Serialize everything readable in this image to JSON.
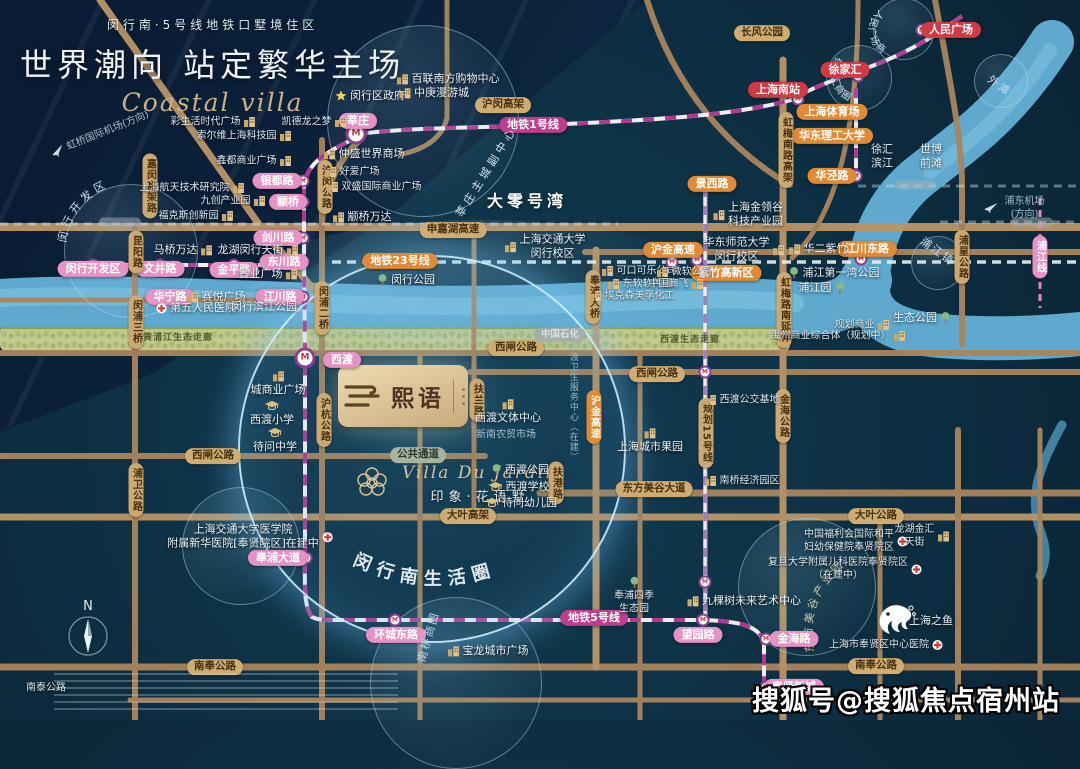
{
  "header": {
    "subtitle": "闵行南·5号线地铁口墅境住区",
    "title": "世界潮向 站定繁华主场",
    "script": "Coastal villa"
  },
  "project": {
    "name": "熙语"
  },
  "villa": {
    "en": "Villa Du Jardin",
    "cn": "印象·花语墅"
  },
  "watermark": "搜狐号@搜狐焦点宿州站",
  "compass": "N",
  "colors": {
    "background": "#0d2e41",
    "river": "#5fa9cf",
    "road": "#a9855c",
    "metro_pink": "#e493c4",
    "metro_magenta": "#bc3e8e",
    "orange": "#df8a35",
    "road_pill": "#cfac72",
    "red": "#cf3b45",
    "green_band": "#c3c98e"
  },
  "curved": {
    "life_circle": "闵行南生活圈",
    "renmin": "人民广场商圈",
    "xujiahui": "徐家汇商圈",
    "kaifaqu": "闵行开发区",
    "dongfang": "东方美谷产业园"
  },
  "labels": [
    {
      "t": "莘庄",
      "x": 358,
      "y": 121,
      "c": "pk"
    },
    {
      "t": "银都路",
      "x": 277,
      "y": 181,
      "c": "pk"
    },
    {
      "t": "颛桥",
      "x": 288,
      "y": 202,
      "c": "pk"
    },
    {
      "t": "剑川路",
      "x": 278,
      "y": 238,
      "c": "pk"
    },
    {
      "t": "东川路",
      "x": 284,
      "y": 262,
      "c": "pk"
    },
    {
      "t": "金平路",
      "x": 234,
      "y": 270,
      "c": "pk"
    },
    {
      "t": "文井路",
      "x": 160,
      "y": 269,
      "c": "pk"
    },
    {
      "t": "闵行开发区",
      "x": 93,
      "y": 269,
      "c": "pk"
    },
    {
      "t": "华宁路",
      "x": 170,
      "y": 297,
      "c": "pk"
    },
    {
      "t": "江川路",
      "x": 280,
      "y": 297,
      "c": "pk"
    },
    {
      "t": "西渡",
      "x": 342,
      "y": 360,
      "c": "pk"
    },
    {
      "t": "奉浦大道",
      "x": 278,
      "y": 558,
      "c": "pk"
    },
    {
      "t": "环城东路",
      "x": 396,
      "y": 635,
      "c": "pk"
    },
    {
      "t": "望园路",
      "x": 698,
      "y": 635,
      "c": "pk"
    },
    {
      "t": "金海路",
      "x": 794,
      "y": 639,
      "c": "pk"
    },
    {
      "t": "奉贤新城",
      "x": 794,
      "y": 687,
      "c": "pk"
    },
    {
      "t": "浦江线",
      "x": 1040,
      "y": 257,
      "c": "pkv"
    },
    {
      "t": "地铁1号线",
      "x": 533,
      "y": 125,
      "c": "mg"
    },
    {
      "t": "地铁5号线",
      "x": 594,
      "y": 618,
      "c": "mg"
    },
    {
      "t": "人民广场",
      "x": 951,
      "y": 30,
      "c": "rd"
    },
    {
      "t": "徐家汇",
      "x": 845,
      "y": 70,
      "c": "rd"
    },
    {
      "t": "上海南站",
      "x": 778,
      "y": 90,
      "c": "rd"
    },
    {
      "t": "上海体育场",
      "x": 832,
      "y": 112,
      "c": "or"
    },
    {
      "t": "华东理工大学",
      "x": 832,
      "y": 136,
      "c": "or"
    },
    {
      "t": "华泾路",
      "x": 832,
      "y": 176,
      "c": "or"
    },
    {
      "t": "景西路",
      "x": 712,
      "y": 184,
      "c": "or"
    },
    {
      "t": "地铁23号线",
      "x": 400,
      "y": 261,
      "c": "or"
    },
    {
      "t": "沪金高速",
      "x": 673,
      "y": 250,
      "c": "or"
    },
    {
      "t": "江川东路",
      "x": 867,
      "y": 249,
      "c": "or"
    },
    {
      "t": "紫竹高新区",
      "x": 726,
      "y": 273,
      "c": "or"
    },
    {
      "t": "沪金高速",
      "x": 594,
      "y": 417,
      "c": "orv"
    },
    {
      "t": "长风公园",
      "x": 762,
      "y": 33,
      "c": "tn"
    },
    {
      "t": "沪闵高架",
      "x": 503,
      "y": 105,
      "c": "tn"
    },
    {
      "t": "申嘉湖高速",
      "x": 453,
      "y": 230,
      "c": "tn"
    },
    {
      "t": "西闸公路",
      "x": 516,
      "y": 348,
      "c": "tn"
    },
    {
      "t": "西闸公路",
      "x": 657,
      "y": 374,
      "c": "tn"
    },
    {
      "t": "西闸公路",
      "x": 213,
      "y": 456,
      "c": "tn"
    },
    {
      "t": "东方美谷大道",
      "x": 654,
      "y": 489,
      "c": "tn"
    },
    {
      "t": "大叶高架",
      "x": 468,
      "y": 516,
      "c": "tn"
    },
    {
      "t": "大叶公路",
      "x": 876,
      "y": 516,
      "c": "tn"
    },
    {
      "t": "南奉公路",
      "x": 876,
      "y": 666,
      "c": "tn"
    },
    {
      "t": "南奉公路",
      "x": 215,
      "y": 667,
      "c": "tn"
    },
    {
      "t": "公共通道",
      "x": 418,
      "y": 455,
      "c": "gn"
    },
    {
      "t": "中国石化",
      "x": 560,
      "y": 335,
      "c": "gy"
    },
    {
      "t": "嘉闵高架路",
      "x": 150,
      "y": 186,
      "c": "tnv"
    },
    {
      "t": "沪闵公路",
      "x": 325,
      "y": 187,
      "c": "tnv"
    },
    {
      "t": "闵浦二桥",
      "x": 322,
      "y": 308,
      "c": "tnv"
    },
    {
      "t": "沪杭公路",
      "x": 324,
      "y": 420,
      "c": "tnv"
    },
    {
      "t": "昆阳路",
      "x": 136,
      "y": 252,
      "c": "tnv"
    },
    {
      "t": "闵浦三桥",
      "x": 136,
      "y": 322,
      "c": "tnv"
    },
    {
      "t": "浦卫公路",
      "x": 136,
      "y": 490,
      "c": "tnv"
    },
    {
      "t": "虹梅南路高架",
      "x": 786,
      "y": 150,
      "c": "tnv"
    },
    {
      "t": "虹梅路南延伸",
      "x": 784,
      "y": 310,
      "c": "tnv"
    },
    {
      "t": "奉浦大桥",
      "x": 593,
      "y": 297,
      "c": "tnv"
    },
    {
      "t": "金海公路",
      "x": 783,
      "y": 416,
      "c": "tnv"
    },
    {
      "t": "扶兰路",
      "x": 477,
      "y": 400,
      "c": "tnv"
    },
    {
      "t": "扶港路",
      "x": 556,
      "y": 483,
      "c": "tnv"
    },
    {
      "t": "浦星公路",
      "x": 962,
      "y": 257,
      "c": "tnv"
    },
    {
      "t": "规划15号线",
      "x": 706,
      "y": 433,
      "c": "tnv"
    },
    {
      "t": "闵行区政府",
      "x": 370,
      "y": 96,
      "c": "wt",
      "i": "star",
      "s": "l"
    },
    {
      "t": "百联南方购物中心",
      "x": 448,
      "y": 79,
      "c": "wt",
      "i": "bld",
      "s": "l"
    },
    {
      "t": "中庚漫游城",
      "x": 434,
      "y": 93,
      "c": "wt",
      "i": "bld",
      "s": "l"
    },
    {
      "t": "仲盛世界商场",
      "x": 364,
      "y": 154,
      "c": "wt",
      "i": "bld",
      "s": "l"
    },
    {
      "t": "颛桥万达",
      "x": 362,
      "y": 217,
      "c": "wt",
      "i": "bld",
      "s": "l"
    },
    {
      "t": "马桥万达",
      "x": 183,
      "y": 250,
      "c": "wt",
      "i": "bld",
      "s": "r"
    },
    {
      "t": "龙湖闵行天街",
      "x": 258,
      "y": 250,
      "c": "wt",
      "i": "bld",
      "s": "r"
    },
    {
      "t": "置业广场",
      "x": 268,
      "y": 274,
      "c": "wt",
      "i": "bld",
      "s": "r"
    },
    {
      "t": "赛悦广场",
      "x": 216,
      "y": 297,
      "c": "wt",
      "i": "bld",
      "s": "l"
    },
    {
      "t": "第五人民医院",
      "x": 196,
      "y": 308,
      "c": "wt",
      "i": "hosp",
      "s": "l"
    },
    {
      "t": "闵行滨江公园",
      "x": 264,
      "y": 307,
      "c": "wt"
    },
    {
      "t": "上海航天技术研究院",
      "x": 192,
      "y": 188,
      "c": "sm",
      "i": "bld",
      "s": "r"
    },
    {
      "t": "九创产业园",
      "x": 233,
      "y": 201,
      "c": "sm",
      "i": "bld",
      "s": "r"
    },
    {
      "t": "福克斯创新园",
      "x": 196,
      "y": 216,
      "c": "sm",
      "i": "bld",
      "s": "r"
    },
    {
      "t": "彩生活时代广场",
      "x": 213,
      "y": 122,
      "c": "sm",
      "i": "bld",
      "s": "r"
    },
    {
      "t": "凯德龙之梦",
      "x": 314,
      "y": 122,
      "c": "sm",
      "i": "bld",
      "s": "r"
    },
    {
      "t": "索尔维上海科技园",
      "x": 244,
      "y": 136,
      "c": "sm",
      "i": "bld",
      "s": "r"
    },
    {
      "t": "鑫都商业广场",
      "x": 254,
      "y": 161,
      "c": "sm",
      "i": "bld",
      "s": "r"
    },
    {
      "t": "好爱广场",
      "x": 352,
      "y": 172,
      "c": "sm",
      "i": "bld",
      "s": "l"
    },
    {
      "t": "双盛国际商业广场",
      "x": 374,
      "y": 187,
      "c": "sm",
      "i": "bld",
      "s": "l"
    },
    {
      "t": "大零号湾",
      "x": 527,
      "y": 202,
      "c": "big"
    },
    {
      "t": "上海交通大学\n闵行校区",
      "x": 545,
      "y": 247,
      "c": "wt",
      "i": "bld",
      "s": "l"
    },
    {
      "t": "闵行公园",
      "x": 406,
      "y": 280,
      "c": "wt",
      "i": "tree",
      "s": "l"
    },
    {
      "t": "可口可乐公司",
      "x": 639,
      "y": 271,
      "c": "sm",
      "i": "bld",
      "s": "l"
    },
    {
      "t": "微软公司",
      "x": 684,
      "y": 272,
      "c": "sm",
      "i": "bld",
      "s": "l"
    },
    {
      "t": "东软软件园",
      "x": 640,
      "y": 284,
      "c": "sm",
      "i": "bld",
      "s": "l"
    },
    {
      "t": "中国商飞",
      "x": 676,
      "y": 284,
      "c": "sm",
      "i": "bld",
      "s": "r"
    },
    {
      "t": "埃克森美孚化工",
      "x": 632,
      "y": 296,
      "c": "sm",
      "i": "bld",
      "s": "l"
    },
    {
      "t": "华东师范大学\n闵行校区",
      "x": 744,
      "y": 250,
      "c": "wt",
      "i": "bld",
      "s": "r"
    },
    {
      "t": "华二紫竹",
      "x": 818,
      "y": 249,
      "c": "wt",
      "i": "bld",
      "s": "l"
    },
    {
      "t": "上海金领谷\n科技产业园",
      "x": 748,
      "y": 215,
      "c": "wt",
      "i": "bld",
      "s": "l"
    },
    {
      "t": "浦江第一湾公园",
      "x": 834,
      "y": 273,
      "c": "wt",
      "i": "tree",
      "s": "l"
    },
    {
      "t": "浦江园",
      "x": 822,
      "y": 288,
      "c": "wt",
      "i": "tree",
      "s": "r"
    },
    {
      "t": "生态公园",
      "x": 922,
      "y": 318,
      "c": "wt",
      "i": "tree",
      "s": "r"
    },
    {
      "t": "规划商业",
      "x": 862,
      "y": 325,
      "c": "sm",
      "i": "bld",
      "s": "r"
    },
    {
      "t": "禹州商业综合体（规划中）",
      "x": 838,
      "y": 336,
      "c": "sm",
      "i": "bld",
      "s": "r"
    },
    {
      "t": "徐汇\n滨江",
      "x": 882,
      "y": 157,
      "c": "wt"
    },
    {
      "t": "世博\n前滩",
      "x": 931,
      "y": 157,
      "c": "wt"
    },
    {
      "t": "浦东机场(方向)",
      "x": 1016,
      "y": 208,
      "c": "fnt",
      "i": "plane",
      "s": "l"
    },
    {
      "t": "虹桥国际机场(方向)",
      "x": 100,
      "y": 134,
      "c": "fnt",
      "i": "plane",
      "s": "l",
      "r": -22
    },
    {
      "t": "城商业广场",
      "x": 278,
      "y": 384,
      "c": "wt",
      "i": "bld",
      "s": "t"
    },
    {
      "t": "西渡小学",
      "x": 272,
      "y": 414,
      "c": "wt",
      "i": "cap",
      "s": "t"
    },
    {
      "t": "待问中学",
      "x": 275,
      "y": 441,
      "c": "wt",
      "i": "cap",
      "s": "t"
    },
    {
      "t": "西渡文体中心",
      "x": 508,
      "y": 412,
      "c": "wt",
      "i": "bld",
      "s": "t"
    },
    {
      "t": "新南农贸市场",
      "x": 506,
      "y": 435,
      "c": "fnt"
    },
    {
      "t": "西渡公园",
      "x": 520,
      "y": 470,
      "c": "wt",
      "i": "tree",
      "s": "l"
    },
    {
      "t": "西渡学校",
      "x": 519,
      "y": 487,
      "c": "wt",
      "i": "cap",
      "s": "l"
    },
    {
      "t": "待问幼儿园",
      "x": 521,
      "y": 503,
      "c": "wt",
      "i": "cap",
      "s": "l"
    },
    {
      "t": "上海城市果园",
      "x": 650,
      "y": 441,
      "c": "wt",
      "i": "bld",
      "s": "t"
    },
    {
      "t": "西渡公交基地",
      "x": 742,
      "y": 400,
      "c": "sm",
      "i": "bld",
      "s": "l"
    },
    {
      "t": "南桥经济园区",
      "x": 742,
      "y": 481,
      "c": "sm",
      "i": "bld",
      "s": "l"
    },
    {
      "t": "上海交通大学医学院\n附属新华医院[奉贤院区]在建中",
      "x": 250,
      "y": 537,
      "c": "wt",
      "i": "hosp",
      "s": "r"
    },
    {
      "t": "宝龙城市广场",
      "x": 488,
      "y": 651,
      "c": "wt",
      "i": "bld",
      "s": "l"
    },
    {
      "t": "奉浦四季\n生态园",
      "x": 634,
      "y": 596,
      "c": "sm",
      "i": "tree",
      "s": "t"
    },
    {
      "t": "九棵树未来艺术中心",
      "x": 744,
      "y": 601,
      "c": "wt",
      "i": "bld",
      "s": "l"
    },
    {
      "t": "中国福利会国际和平\n妇幼保健院奉贤院区",
      "x": 856,
      "y": 541,
      "c": "sm",
      "i": "hosp",
      "s": "r"
    },
    {
      "t": "复旦大学附属儿科医院奉贤院区\n（在建中）",
      "x": 845,
      "y": 569,
      "c": "sm",
      "i": "hosp",
      "s": "r"
    },
    {
      "t": "龙湖金汇\n天街",
      "x": 922,
      "y": 536,
      "c": "sm",
      "i": "bld",
      "s": "r"
    },
    {
      "t": "上海之鱼",
      "x": 931,
      "y": 621,
      "c": "wt"
    },
    {
      "t": "上海市奉贤区中心医院",
      "x": 886,
      "y": 645,
      "c": "sm",
      "i": "hosp",
      "s": "r"
    },
    {
      "t": "南泰公路",
      "x": 46,
      "y": 688,
      "c": "sm"
    },
    {
      "t": "黄浦江生态走廊",
      "x": 178,
      "y": 339,
      "c": "band"
    },
    {
      "t": "西渡生态走廊",
      "x": 690,
      "y": 341,
      "c": "band"
    },
    {
      "t": "西渡卫生服务中心（在建）",
      "x": 572,
      "y": 402,
      "c": "fvv"
    },
    {
      "t": "莘庄主城副中心",
      "x": 487,
      "y": 172,
      "c": "spread",
      "r": -58
    },
    {
      "t": "浦江镇",
      "x": 937,
      "y": 252,
      "c": "spread2",
      "r": 36
    },
    {
      "t": "南桥商圈",
      "x": 429,
      "y": 637,
      "c": "spread2",
      "r": -74
    },
    {
      "t": "外滩",
      "x": 999,
      "y": 86,
      "c": "spread2",
      "r": 35
    }
  ],
  "stations": [
    [
      356,
      134,
      1
    ],
    [
      303,
      181,
      0
    ],
    [
      303,
      202,
      0
    ],
    [
      303,
      238,
      0
    ],
    [
      303,
      262,
      0
    ],
    [
      93,
      265,
      0
    ],
    [
      160,
      265,
      0
    ],
    [
      234,
      265,
      0
    ],
    [
      303,
      297,
      0
    ],
    [
      305,
      358,
      1
    ],
    [
      306,
      558,
      0
    ],
    [
      395,
      620,
      0
    ],
    [
      703,
      620,
      0
    ],
    [
      766,
      639,
      0
    ],
    [
      766,
      687,
      0
    ],
    [
      798,
      99,
      0
    ],
    [
      858,
      76,
      0
    ],
    [
      922,
      30,
      0
    ],
    [
      856,
      112,
      0
    ],
    [
      856,
      136,
      0
    ],
    [
      856,
      176,
      0
    ],
    [
      672,
      262,
      0
    ],
    [
      697,
      260,
      0
    ],
    [
      861,
      259,
      0
    ],
    [
      705,
      372,
      0
    ],
    [
      705,
      582,
      0
    ]
  ]
}
